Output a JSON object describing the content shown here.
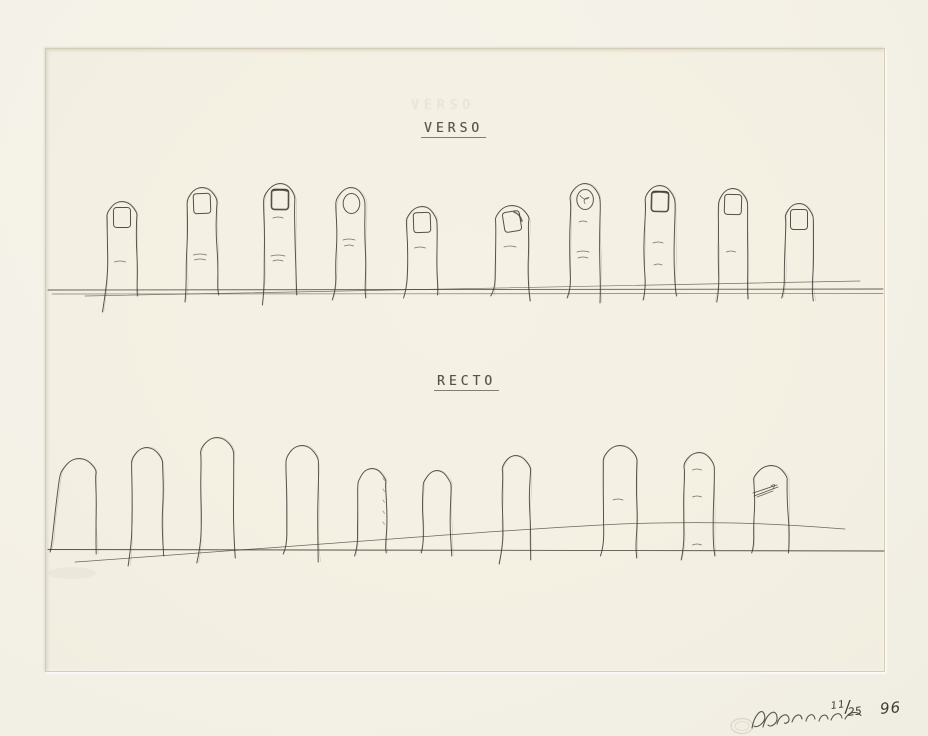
{
  "artwork": {
    "verso_label": "VERSO",
    "verso_ghost": "VERSO",
    "recto_label": "RECTO",
    "edition_numerator": "11",
    "edition_separator": "/",
    "edition_denominator": "25",
    "year": "96"
  },
  "colors": {
    "paper": "#f4f1e7",
    "plate": "#f3efe2",
    "ink": "#3e3a33",
    "pencil": "#4a463e",
    "plate_mark": "#bab096"
  },
  "drawing": {
    "plate": {
      "x": 45,
      "y": 48,
      "w": 838,
      "h": 622
    },
    "verso_row": {
      "description": "ten upright fingers with fingernails resting on a double baseline",
      "baselines": [
        {
          "x1": 48,
          "y1": 290,
          "x2": 883,
          "y2": 289
        },
        {
          "x1": 52,
          "y1": 294,
          "x2": 883,
          "y2": 293.5
        }
      ],
      "sloped_line": {
        "x1": 85,
        "y1": 296,
        "x2": 860,
        "y2": 281
      },
      "fingers": [
        {
          "cx": 122,
          "top": 201,
          "w": 30,
          "bottom": 292,
          "tailL": 20,
          "tailR": 4,
          "nail": "square",
          "marks": [
            {
              "y": 262,
              "len": 11
            }
          ]
        },
        {
          "cx": 202,
          "top": 187,
          "w": 30,
          "bottom": 292,
          "tailL": 10,
          "tailR": 3,
          "nail": "square",
          "marks": [
            {
              "y": 255,
              "len": 13
            },
            {
              "y": 260,
              "len": 11
            }
          ]
        },
        {
          "cx": 280,
          "top": 183,
          "w": 31,
          "bottom": 292,
          "tailL": 13,
          "tailR": 3,
          "nail": "square-dark",
          "marks": [
            {
              "y": 218,
              "len": 10
            },
            {
              "y": 256,
              "len": 14
            },
            {
              "y": 261,
              "len": 10
            }
          ]
        },
        {
          "cx": 351,
          "top": 187,
          "w": 29,
          "bottom": 292,
          "tailL": 8,
          "tailR": 6,
          "nail": "round",
          "marks": [
            {
              "y": 240,
              "len": 12
            },
            {
              "y": 246,
              "len": 9
            }
          ]
        },
        {
          "cx": 422,
          "top": 206,
          "w": 30,
          "bottom": 292,
          "tailL": 6,
          "tailR": 3,
          "nail": "square",
          "marks": [
            {
              "y": 248,
              "len": 11
            }
          ]
        },
        {
          "cx": 512,
          "top": 205,
          "w": 34,
          "bottom": 292,
          "tailL": 4,
          "tailR": 9,
          "nail": "slant",
          "marks": [
            {
              "y": 247,
              "len": 12
            }
          ]
        },
        {
          "cx": 585,
          "top": 183,
          "w": 30,
          "bottom": 292,
          "tailL": 6,
          "tailR": 11,
          "nail": "round-scribble",
          "marks": [
            {
              "y": 222,
              "len": 8
            },
            {
              "y": 252,
              "len": 12
            },
            {
              "y": 258,
              "len": 10
            }
          ]
        },
        {
          "cx": 660,
          "top": 185,
          "w": 30,
          "bottom": 292,
          "tailL": 8,
          "tailR": 4,
          "nail": "square-dark",
          "marks": [
            {
              "y": 243,
              "len": 10
            },
            {
              "y": 265,
              "len": 8
            }
          ]
        },
        {
          "cx": 733,
          "top": 188,
          "w": 29,
          "bottom": 292,
          "tailL": 10,
          "tailR": 7,
          "nail": "square",
          "marks": [
            {
              "y": 252,
              "len": 9
            }
          ]
        },
        {
          "cx": 799,
          "top": 203,
          "w": 28,
          "bottom": 292,
          "tailL": 6,
          "tailR": 9,
          "nail": "square",
          "marks": []
        }
      ]
    },
    "recto_row": {
      "description": "ten upright fingers without nails on a baseline crossed by a rising arc",
      "baseline": {
        "x1": 48,
        "y1": 549.5,
        "x2": 884,
        "y2": 551
      },
      "arc_line": {
        "x1": 75,
        "y1": 562,
        "c1x": 300,
        "c1y": 546,
        "midx": 620,
        "midy": 524,
        "c2x": 740,
        "c2y": 520,
        "x2": 845,
        "y2": 529
      },
      "fingers": [
        {
          "cx": 79,
          "top": 458,
          "w": 34,
          "bottom": 549,
          "tailL": 3,
          "tailR": 5,
          "skewL": -10,
          "marks": []
        },
        {
          "cx": 147,
          "top": 447,
          "w": 31,
          "bottom": 549,
          "tailL": 17,
          "tailR": 7,
          "marks": []
        },
        {
          "cx": 217,
          "top": 437,
          "w": 33,
          "bottom": 549,
          "tailL": 14,
          "tailR": 9,
          "marks": []
        },
        {
          "cx": 302,
          "top": 445,
          "w": 32,
          "bottom": 549,
          "tailL": 5,
          "tailR": 13,
          "marks": []
        },
        {
          "cx": 372,
          "top": 468,
          "w": 28,
          "bottom": 549,
          "tailL": 7,
          "tailR": 4,
          "texture": true,
          "marks": []
        },
        {
          "cx": 437,
          "top": 470,
          "w": 28,
          "bottom": 549,
          "tailL": 4,
          "tailR": 7,
          "marks": []
        },
        {
          "cx": 516,
          "top": 455,
          "w": 28,
          "bottom": 549,
          "tailL": 15,
          "tailR": 11,
          "marks": []
        },
        {
          "cx": 620,
          "top": 445,
          "w": 33,
          "bottom": 549,
          "tailL": 7,
          "tailR": 9,
          "marks": [
            {
              "y": 500,
              "len": 10
            }
          ]
        },
        {
          "cx": 699,
          "top": 452,
          "w": 30,
          "bottom": 549,
          "tailL": 11,
          "tailR": 7,
          "marks": [
            {
              "y": 470,
              "len": 9
            },
            {
              "y": 497,
              "len": 9
            },
            {
              "y": 545,
              "len": 9
            }
          ]
        },
        {
          "cx": 771,
          "top": 465,
          "w": 34,
          "bottom": 549,
          "tailL": 4,
          "tailR": 4,
          "scribble": {
            "x": 764,
            "y": 490
          },
          "marks": []
        }
      ]
    },
    "blind_stamp": {
      "cx": 742,
      "cy": 726,
      "rx": 11,
      "ry": 7.5
    },
    "signature_scrawl": true
  }
}
